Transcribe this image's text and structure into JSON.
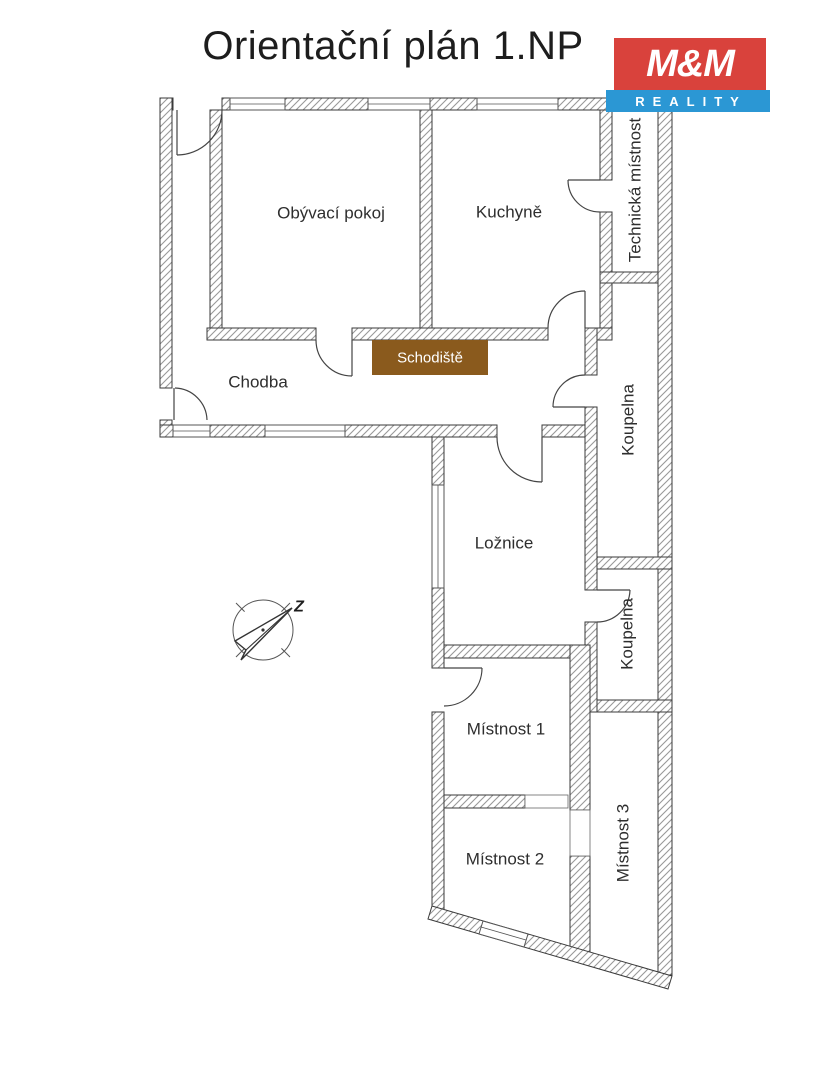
{
  "header": {
    "title": "Orientační plán 1.NP"
  },
  "logo": {
    "top_text": "M&M",
    "bottom_text": "REALITY",
    "red_color": "#d9423c",
    "blue_color": "#2b97d4"
  },
  "floor_plan": {
    "rooms": {
      "living_room": "Obývací pokoj",
      "kitchen": "Kuchyně",
      "technical_room": "Technická místnost",
      "hallway": "Chodba",
      "staircase": "Schodiště",
      "bathroom_1": "Koupelna",
      "bedroom": "Ložnice",
      "bathroom_2": "Koupelna",
      "room_1": "Místnost 1",
      "room_2": "Místnost 2",
      "room_3": "Místnost 3"
    },
    "staircase_color": "#8a5a1d",
    "wall_line_color": "#3a3a3a",
    "hatch_color": "#999999",
    "compass_letter": "Z"
  }
}
